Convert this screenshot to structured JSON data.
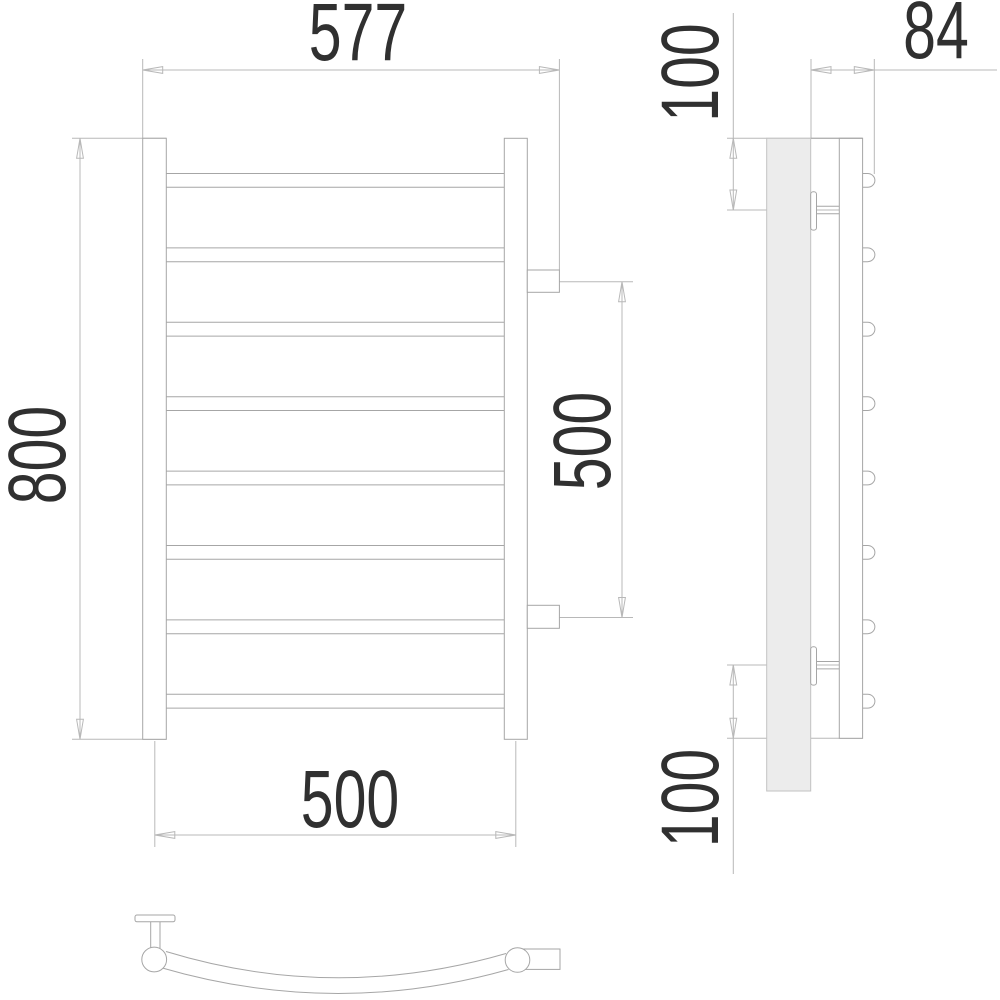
{
  "drawing": {
    "kind": "towel-rail technical drawing",
    "views": {
      "front": {
        "dimensions": {
          "overall_width": "577",
          "height": "800",
          "connection_center_spacing": "500",
          "pipe_center_spacing": "500"
        }
      },
      "side": {
        "dimensions": {
          "depth": "84",
          "top_bracket_offset": "100",
          "bottom_bracket_offset": "100"
        }
      }
    },
    "product": {
      "rungs": 8
    },
    "colors": {
      "background": "#ffffff",
      "line": "#a6a6a6",
      "dim_line": "#b8b8b8",
      "text": "#303030",
      "wall_fill": "#ececec",
      "wall_stroke": "#c2c2c2"
    }
  }
}
